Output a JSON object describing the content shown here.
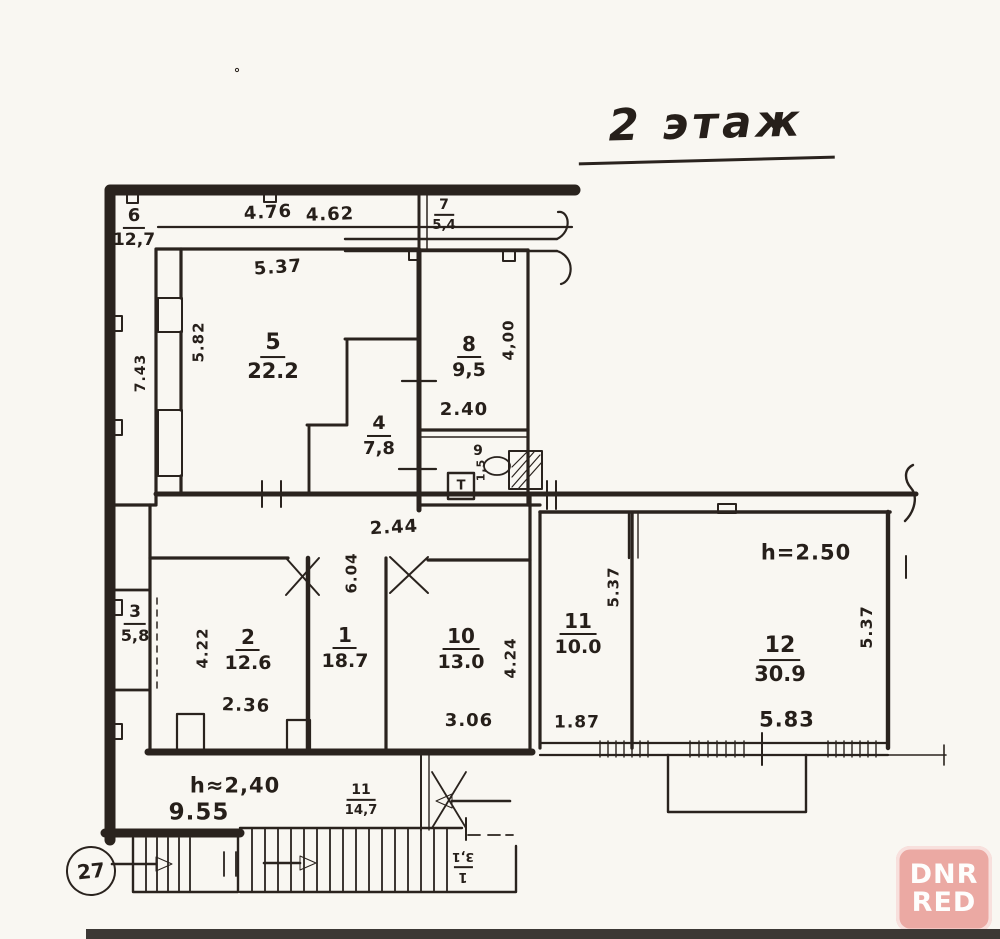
{
  "title": "2 этаж",
  "rooms": {
    "r1": {
      "num": "1",
      "area": "18.7"
    },
    "r2": {
      "num": "2",
      "area": "12.6"
    },
    "r3": {
      "num": "3",
      "area": "5,8"
    },
    "r4": {
      "num": "4",
      "area": "7,8"
    },
    "r5": {
      "num": "5",
      "area": "22.2"
    },
    "r6": {
      "num": "6",
      "area": "12,7"
    },
    "r7": {
      "num": "7",
      "area": "5,4"
    },
    "r8": {
      "num": "8",
      "area": "9,5"
    },
    "r9": {
      "num": "9",
      "door_width": "1,5"
    },
    "r10": {
      "num": "10",
      "area": "13.0"
    },
    "r11": {
      "num": "11",
      "area": "10.0"
    },
    "r12": {
      "num": "12",
      "area": "30.9"
    }
  },
  "stairs": {
    "flight_main": {
      "num": "11",
      "area": "14,7"
    },
    "flight_entry": {
      "num": "1",
      "area": "3,1"
    }
  },
  "dims": {
    "d476": "4.76",
    "d462": "4.62",
    "d537_top": "5.37",
    "d582": "5.82",
    "d743": "7.43",
    "d400": "4,00",
    "d240": "2.40",
    "d244": "2.44",
    "d604": "6.04",
    "d422": "4.22",
    "d236": "2.36",
    "d306": "3.06",
    "d424": "4.24",
    "d537_r11": "5.37",
    "d187": "1.87",
    "h250": "h=2.50",
    "d537_r12": "5.37",
    "d583": "5.83",
    "h240": "h≈2,40",
    "d955": "9.55"
  },
  "fixtures": {
    "toilet_tank": "T"
  },
  "stamp": {
    "number": "27"
  },
  "watermark": {
    "line1": "DNR",
    "line2": "RED"
  },
  "colors": {
    "ink": "#2a231e",
    "paper": "#f9f7f2",
    "watermark_bg": "#ea9f99",
    "watermark_text": "#ffffff",
    "scan_strip": "#3c3835"
  }
}
